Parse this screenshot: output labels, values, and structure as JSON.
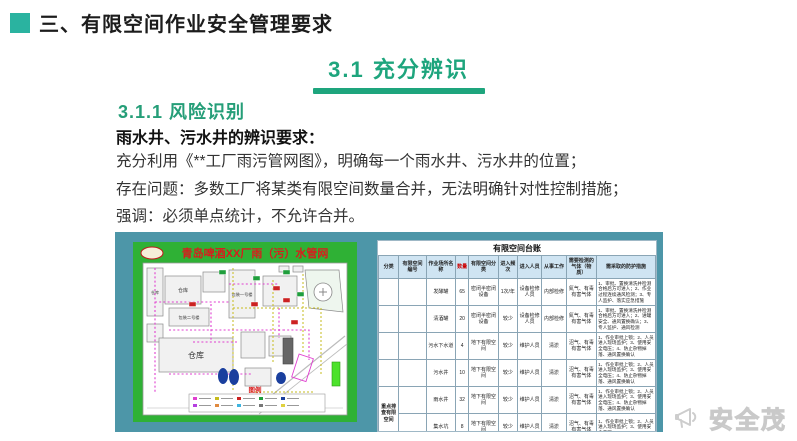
{
  "page": {
    "title": "三、有限空间作业安全管理要求",
    "section_title": "3.1  充分辨识",
    "subsection_title": "3.1.1  风险识别",
    "subheading": "雨水井、污水井的辨识要求：",
    "body_lines": [
      "充分利用《**工厂雨污管网图》，明确每一个雨水井、污水井的位置；",
      "存在问题：多数工厂将某类有限空间数量合并，无法明确针对性控制措施；",
      "强调：必须单点统计，不允许合并。"
    ]
  },
  "colors": {
    "accent_teal": "#2ab3a0",
    "heading_green": "#1ea57d",
    "panel_teal": "#4d96a8",
    "map_green": "#2fb135",
    "table_header_blue": "#cfe4f2",
    "qty_red": "#cc0000"
  },
  "map": {
    "title": "青岛啤酒XX厂雨（污）水管网",
    "legend_label": "图例",
    "labels": {
      "warehouse_big": "仓库",
      "warehouse_1": "仓库",
      "warehouse_2": "仓库",
      "building_pack2": "包装二号楼",
      "building_pack1": "包装一号楼"
    }
  },
  "ledger": {
    "title": "有限空间台账",
    "columns": [
      "分类",
      "有限空间编号",
      "作业场所名称",
      "数量",
      "有限空间分类",
      "进入频次",
      "进入人员",
      "从事工作",
      "需要检测的气体（物质）",
      "需采取的防护措施"
    ],
    "category_label": "重点排查有限空间",
    "rows": [
      {
        "name": "发酵罐",
        "qty": "65",
        "type": "密闭半密闭设备",
        "freq": "1次/年",
        "people": "设备检修人员",
        "work": "内部检修",
        "gas": "氮气、有毒有害气体",
        "measures": "1、审批、置换清洗并检测合格后方可进入；2、作业过程连续通风检测；3、专人监护、落实应急措施"
      },
      {
        "name": "清酒罐",
        "qty": "20",
        "type": "密闭半密闭设备",
        "freq": "较少",
        "people": "设备检修人员",
        "work": "内部检修",
        "gas": "氮气、有毒有害气体",
        "measures": "1、审批、置换清洗并检测合格后方可进入；2、进罐安全、通风置换确认；3、专人监护、通风检测"
      },
      {
        "name": "污水下水道",
        "qty": "4",
        "type": "地下有限空间",
        "freq": "较少",
        "people": "维护人员",
        "work": "清淤",
        "gas": "沼气、有毒有害气体",
        "measures": "1、作业审批上锁；2、人员进入现场监护；3、使用安全电压；4、防止杂物掉落、通风置换确认"
      },
      {
        "name": "污水井",
        "qty": "10",
        "type": "地下有限空间",
        "freq": "较少",
        "people": "维护人员",
        "work": "清淤",
        "gas": "沼气、有毒有害气体",
        "measures": "1、作业审批上锁；2、人员进入现场监护；3、使用安全电压；4、防止杂物掉落、通风置换确认"
      },
      {
        "name": "雨水井",
        "qty": "32",
        "type": "地下有限空间",
        "freq": "较少",
        "people": "维护人员",
        "work": "清淤",
        "gas": "沼气、有毒有害气体",
        "measures": "1、作业审批上锁；2、人员进入现场监护；3、使用安全电压；4、防止杂物掉落、通风置换确认"
      },
      {
        "name": "集水坑",
        "qty": "8",
        "type": "地下有限空间",
        "freq": "较少",
        "people": "维护人员",
        "work": "清淤",
        "gas": "沼气、有毒有害气体",
        "measures": "1、作业审批上锁；2、人员进入现场监护；3、使用安全电压"
      }
    ]
  },
  "watermark": {
    "text": "安全茂",
    "icon": "megaphone-icon"
  }
}
